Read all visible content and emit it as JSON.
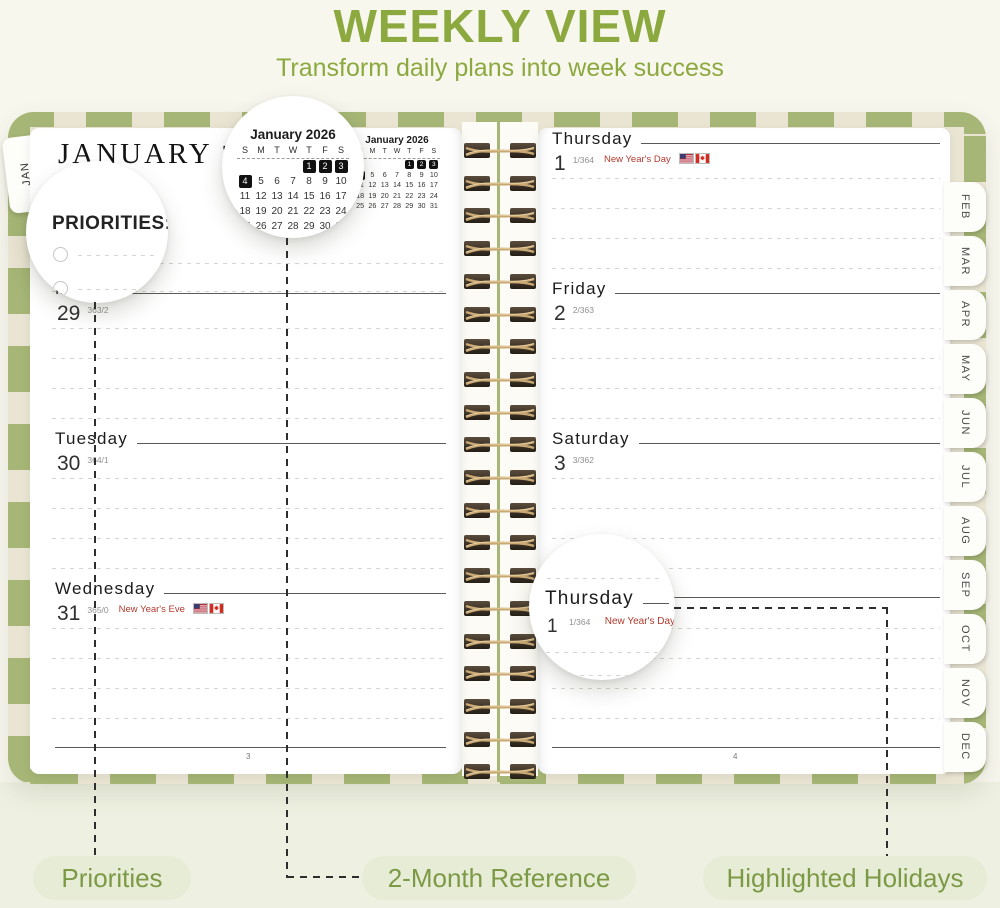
{
  "header": {
    "title": "WEEKLY VIEW",
    "subtitle": "Transform daily plans into week success"
  },
  "planner": {
    "jan_tab": "JAN",
    "month_header": "JANUARY",
    "year_header": "2026",
    "priorities_heading": "PRIORITIES:",
    "left_page_number": "3",
    "right_page_number": "4",
    "mini_calendar": {
      "title": "January 2026",
      "weekdays": [
        "S",
        "M",
        "T",
        "W",
        "T",
        "F",
        "S"
      ],
      "weeks": [
        [
          "",
          "",
          "",
          "",
          "1",
          "2",
          "3"
        ],
        [
          "4",
          "5",
          "6",
          "7",
          "8",
          "9",
          "10"
        ],
        [
          "11",
          "12",
          "13",
          "14",
          "15",
          "16",
          "17"
        ],
        [
          "18",
          "19",
          "20",
          "21",
          "22",
          "23",
          "24"
        ],
        [
          "25",
          "26",
          "27",
          "28",
          "29",
          "30",
          "31"
        ]
      ],
      "highlighted": [
        "1",
        "2",
        "3",
        "4"
      ]
    },
    "left_days": [
      {
        "name": "Monday",
        "date": "29",
        "day_count": "363/2",
        "holiday": "",
        "flags": []
      },
      {
        "name": "Tuesday",
        "date": "30",
        "day_count": "364/1",
        "holiday": "",
        "flags": []
      },
      {
        "name": "Wednesday",
        "date": "31",
        "day_count": "365/0",
        "holiday": "New Year's Eve",
        "flags": [
          "us",
          "ca"
        ]
      }
    ],
    "right_days": [
      {
        "name": "Thursday",
        "date": "1",
        "day_count": "1/364",
        "holiday": "New Year's Day",
        "flags": [
          "us",
          "ca"
        ]
      },
      {
        "name": "Friday",
        "date": "2",
        "day_count": "2/363",
        "holiday": "",
        "flags": []
      },
      {
        "name": "Saturday",
        "date": "3",
        "day_count": "3/362",
        "holiday": "",
        "flags": []
      }
    ],
    "month_tabs": [
      "FEB",
      "MAR",
      "APR",
      "MAY",
      "JUN",
      "JUL",
      "AUG",
      "SEP",
      "OCT",
      "NOV",
      "DEC"
    ]
  },
  "magnifier_day": {
    "name": "Thursday",
    "date": "1",
    "day_count": "1/364",
    "holiday": "New Year's Day",
    "flags": [
      "us",
      "ca"
    ]
  },
  "callouts": {
    "priorities": "Priorities",
    "reference": "2-Month Reference",
    "holidays": "Highlighted Holidays"
  },
  "colors": {
    "accent_green": "#8ba93f",
    "pill_bg": "#e7ecd6",
    "pill_text": "#7c9a45",
    "cover_green": "#a6b676",
    "cover_cream": "#eae5d3",
    "holiday_red": "#b23a2e",
    "calendar_highlight": "#111111",
    "spiral_wire": "#c9a874"
  }
}
